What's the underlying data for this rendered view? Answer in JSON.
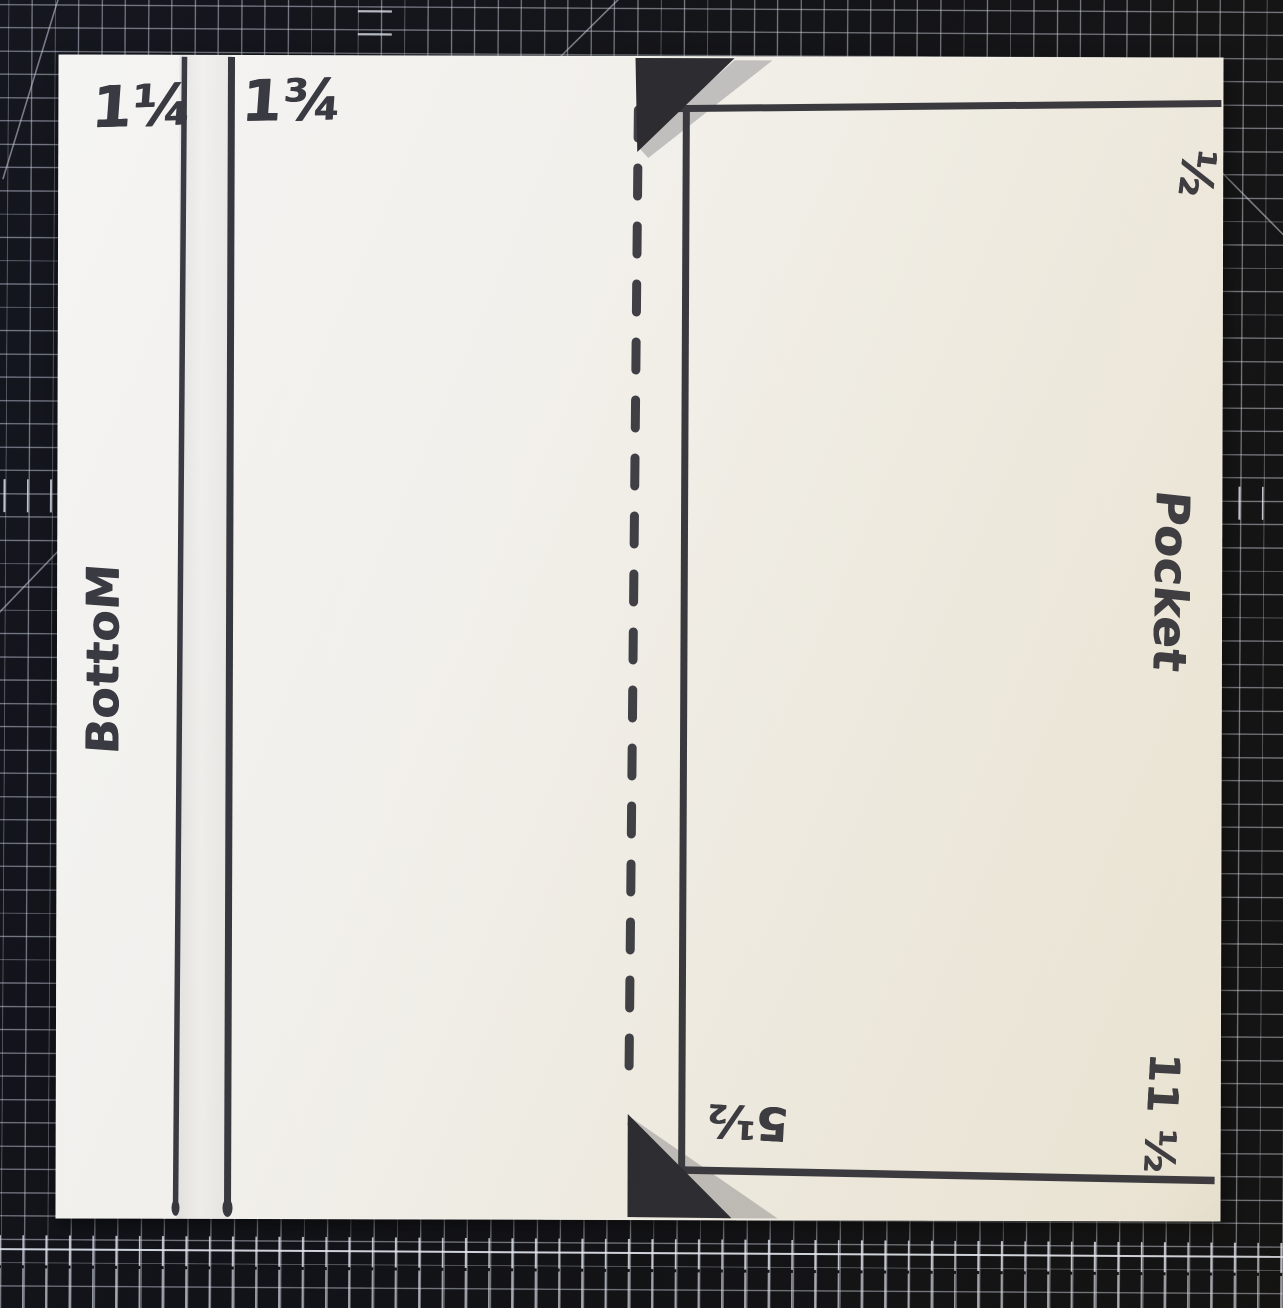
{
  "scene": {
    "title": "Hand-drawn pocket template on cutting mat",
    "mat_color": "#0c0d11",
    "grid_color": "#cbd0dc",
    "paper_color": "#f2f0e9",
    "marker_color": "#36363c"
  },
  "labels": {
    "score_one_quarter": "1¼",
    "score_three_quarter": "1¾",
    "bottom_flap": "BottoM",
    "pocket": "Pocket",
    "half_inch": "½",
    "eleven_half": "11 ½",
    "five_half": "5½"
  }
}
